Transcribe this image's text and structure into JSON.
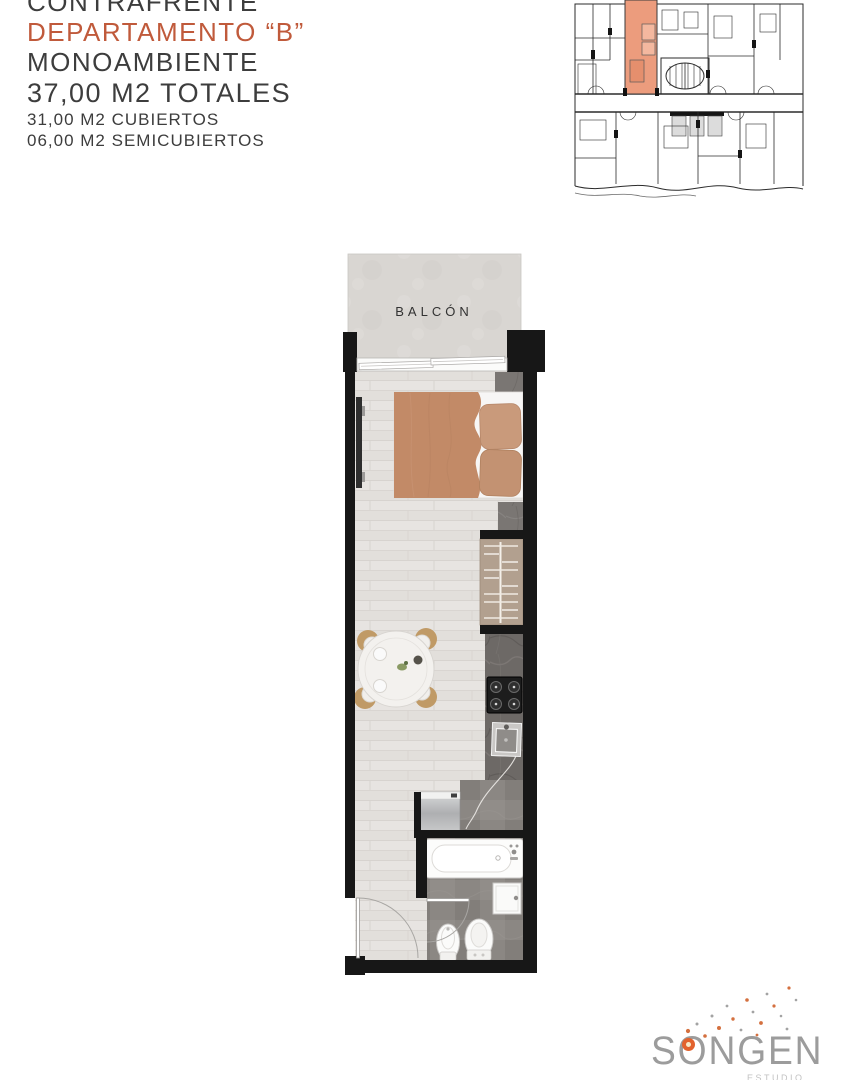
{
  "header": {
    "orientation": "CONTRAFRENTE",
    "unit": "DEPARTAMENTO “B”",
    "layout": "MONOAMBIENTE",
    "total_area": "37,00 M2 TOTALES",
    "covered_area": "31,00 M2 CUBIERTOS",
    "semicovered_area": "06,00 M2 SEMICUBIERTOS"
  },
  "floor_plan": {
    "balcony_label": "BALCÓN"
  },
  "key_plan": {
    "highlight_color": "#ec9c7d"
  },
  "logo": {
    "brand": "SONGEN",
    "subtitle": "ESTUDIO"
  },
  "colors": {
    "accent_text": "#c05a3b",
    "body_text": "#3d3d3d",
    "wall": "#171717",
    "logo_gray": "#9c9c9c",
    "logo_accent": "#e2622d"
  }
}
